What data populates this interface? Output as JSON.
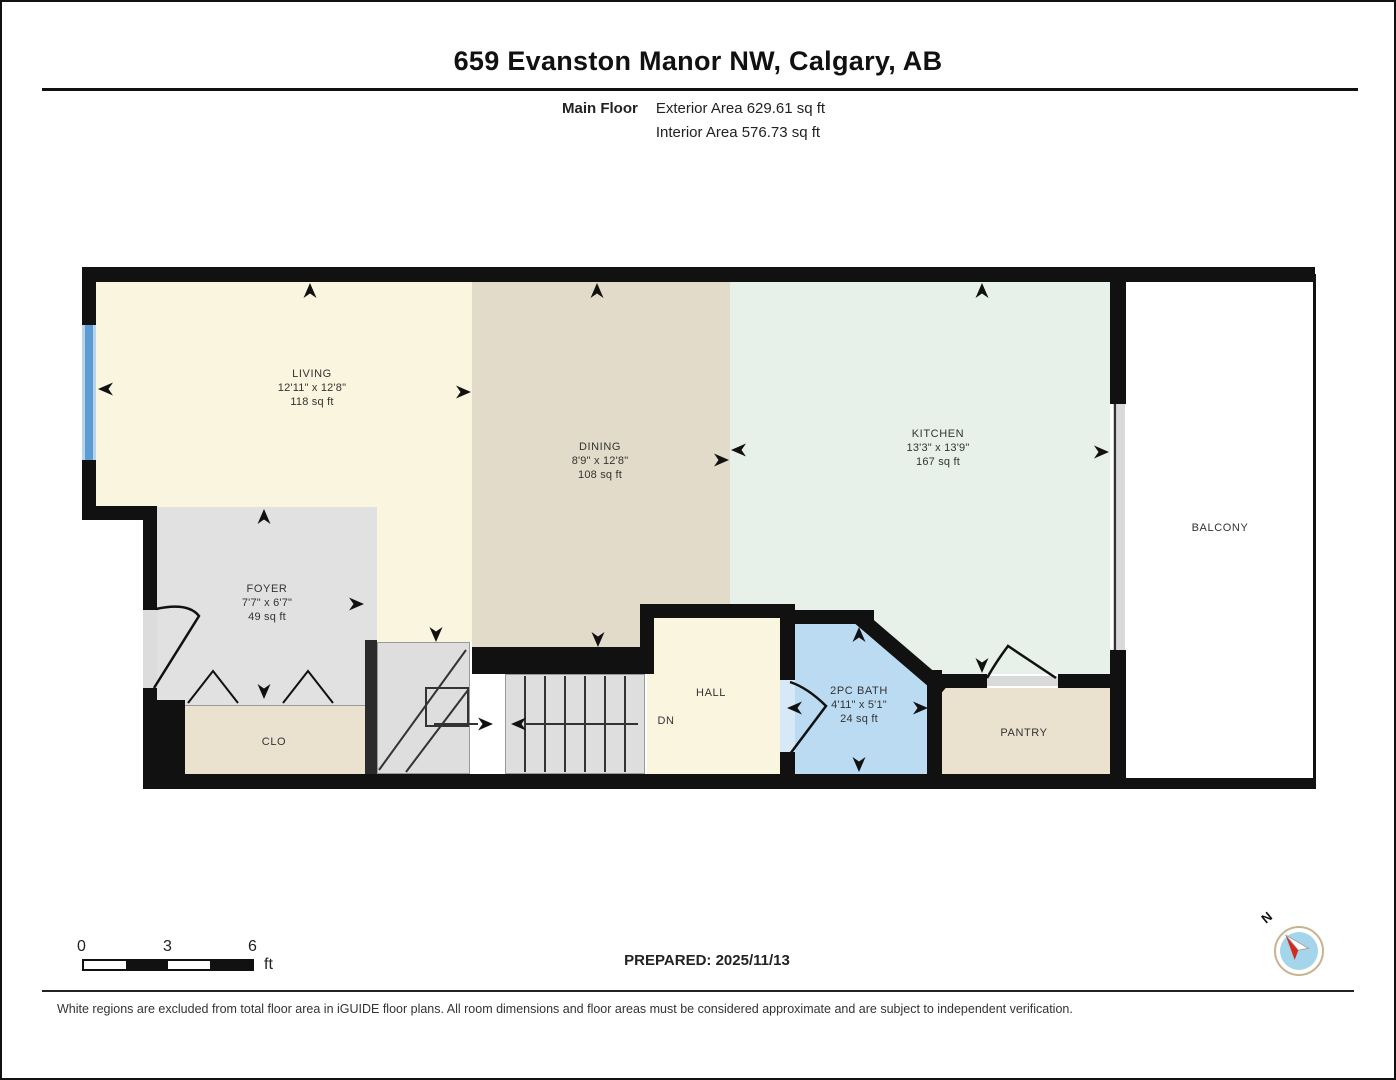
{
  "header": {
    "title": "659 Evanston Manor NW, Calgary, AB",
    "floor_label": "Main Floor",
    "exterior_area": "Exterior Area 629.61 sq ft",
    "interior_area": "Interior Area 576.73 sq ft"
  },
  "rooms": {
    "living": {
      "name": "LIVING",
      "dims": "12'11\" x 12'8\"",
      "area": "118 sq ft"
    },
    "dining": {
      "name": "DINING",
      "dims": "8'9\" x 12'8\"",
      "area": "108 sq ft"
    },
    "kitchen": {
      "name": "KITCHEN",
      "dims": "13'3\" x 13'9\"",
      "area": "167 sq ft"
    },
    "foyer": {
      "name": "FOYER",
      "dims": "7'7\" x 6'7\"",
      "area": "49 sq ft"
    },
    "bath": {
      "name": "2PC BATH",
      "dims": "4'11\" x 5'1\"",
      "area": "24 sq ft"
    },
    "hall": {
      "name": "HALL"
    },
    "closet": {
      "name": "CLO"
    },
    "pantry": {
      "name": "PANTRY"
    },
    "balcony": {
      "name": "BALCONY"
    },
    "stairs": {
      "down_label": "DN"
    }
  },
  "scale_bar": {
    "tick_0": "0",
    "tick_1": "3",
    "tick_2": "6",
    "unit": "ft"
  },
  "prepared_label": "PREPARED: 2025/11/13",
  "compass": {
    "north_label": "N"
  },
  "footer": {
    "disclaimer": "White regions are excluded from total floor area in iGUIDE floor plans. All room dimensions and floor areas must be considered approximate and are subject to independent verification."
  },
  "colors": {
    "wall": "#111111",
    "living": "#FAF5DF",
    "dining": "#E3DBC9",
    "kitchen": "#E7F0E9",
    "foyer": "#E1E1E1",
    "stairs": "#DEDEDE",
    "bath": "#BBDBF3",
    "closet": "#EBE1CF",
    "window": "#5C9CD3",
    "window_edge": "#B7D4EC",
    "compass_blue": "#A5D5EA",
    "compass_red": "#D42B1E"
  }
}
